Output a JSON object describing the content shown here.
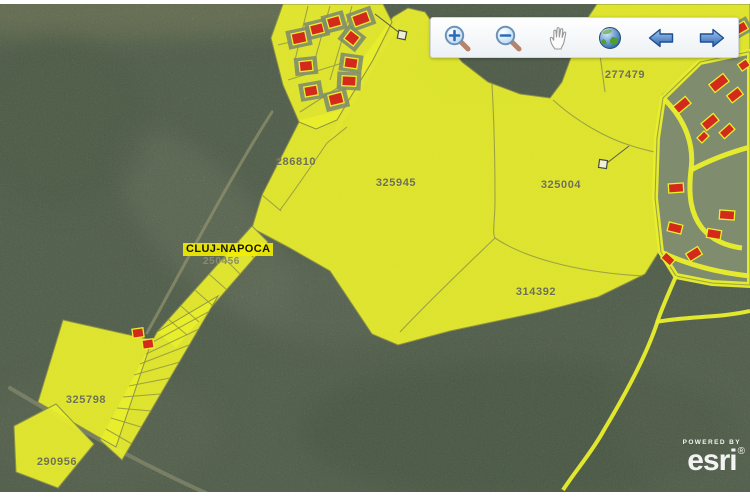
{
  "toolbar": {
    "buttons": [
      {
        "icon": "zoom-in-magnifier"
      },
      {
        "icon": "zoom-out-magnifier"
      },
      {
        "icon": "pan-hand"
      },
      {
        "icon": "full-extent-globe"
      },
      {
        "icon": "previous-extent-arrow"
      },
      {
        "icon": "next-extent-arrow"
      }
    ]
  },
  "map": {
    "city_label": {
      "name": "CLUJ-NAPOCA",
      "code": "250456"
    },
    "parcels": [
      {
        "code": "277479"
      },
      {
        "code": "286810"
      },
      {
        "code": "325945"
      },
      {
        "code": "325004"
      },
      {
        "code": "314392"
      },
      {
        "code": "325798"
      },
      {
        "code": "290956"
      }
    ],
    "colors": {
      "parcel_fill": "#e9ef2d",
      "parcel_line": "#8d9246",
      "building_fill": "#d42a1c",
      "forest_base": "#5e7257",
      "label_text": "#6d705a"
    }
  },
  "attribution": {
    "powered_by": "POWERED BY",
    "brand": "esri",
    "mark": "®"
  }
}
